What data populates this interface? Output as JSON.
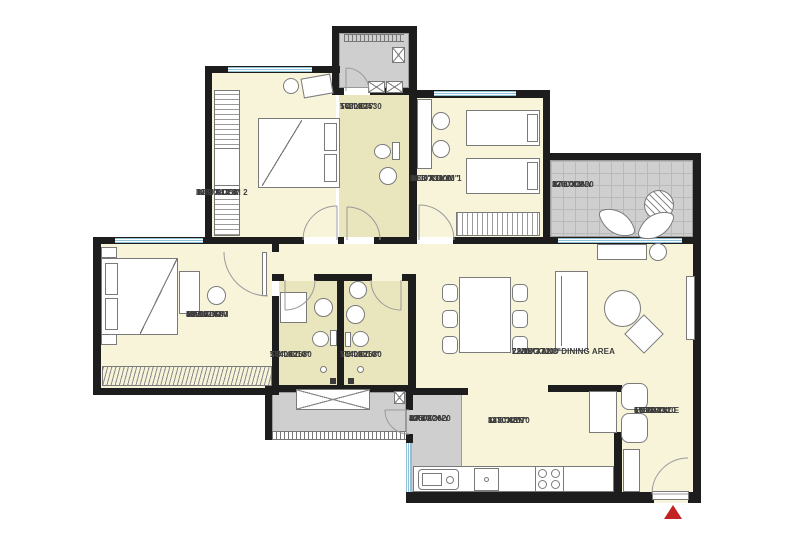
{
  "title": "2BHK-apartment-floor-plan",
  "colors": {
    "wall": "#1d1d1d",
    "room": "#f7f4da",
    "toilet": "#e9e5bc",
    "gray": "#cfcfcf",
    "window": "#8fc0d6",
    "marker": "#c32222",
    "text": "#3c3c3c",
    "line": "#7a7a7a"
  },
  "rooms": [
    {
      "id": "bedroom2",
      "lines": [
        "BED ROOM 2"
      ],
      "mm": "3280X4350",
      "ft": "10'9\"X14'3\""
    },
    {
      "id": "toilet-top",
      "lines": [
        "TOILET"
      ],
      "mm": "1630X2530",
      "ft": "5'4\"X8'4\""
    },
    {
      "id": "bedroom1",
      "lines": [
        "BED ROOM 1"
      ],
      "mm": "3200X3600",
      "ft": "10'6\"X11'10\""
    },
    {
      "id": "balcony",
      "lines": [
        "BALCONY"
      ],
      "mm": "3780X1830",
      "ft": "12'6\"X6'"
    },
    {
      "id": "master-bedroom",
      "lines": [
        "MASTER",
        "BEDROOM"
      ],
      "mm": "4300X3780",
      "ft": "14'X12'6\""
    },
    {
      "id": "toilet-left",
      "lines": [
        "TOILET"
      ],
      "mm": "1640X2680",
      "ft": "5'5\"X8'10\""
    },
    {
      "id": "toilet-right",
      "lines": [
        "TOILET"
      ],
      "mm": "1640X2680",
      "ft": "5'5\"X8'10\""
    },
    {
      "id": "living-dining",
      "lines": [
        "LIVING AND DINING AREA"
      ],
      "mm": "7280X3730",
      "ft": "23'12\"X12'3\""
    },
    {
      "id": "kitchen",
      "lines": [
        "KITCHEN"
      ],
      "mm": "3830X2670",
      "ft": "12'6\"X8'9\""
    },
    {
      "id": "dry-balcony",
      "lines": [
        "DRY",
        "BALCONY"
      ],
      "mm": "1250X2620",
      "ft": "4'X8'6\""
    },
    {
      "id": "entrance-lobby",
      "lines": [
        "ENTRANCE",
        "LOBBY"
      ],
      "mm": "1950X2820",
      "ft": "6'5\"X9'3\""
    }
  ]
}
